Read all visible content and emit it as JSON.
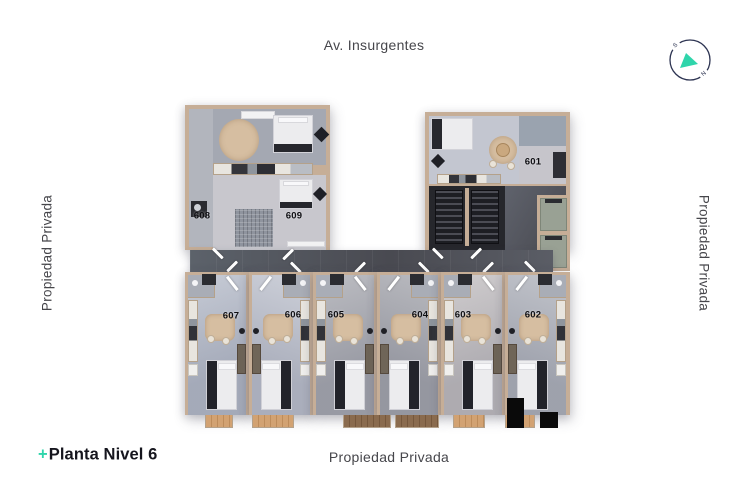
{
  "labels": {
    "street": "Av. Insurgentes",
    "left": "Propiedad Privada",
    "right": "Propiedad Privada",
    "bottom": "Propiedad Privada"
  },
  "footer": {
    "plus": "+",
    "title": "Planta Nivel 6"
  },
  "compass": {
    "south": "S",
    "north": "N"
  },
  "colors": {
    "accent_teal": "#2fd5ab",
    "compass_navy": "#2d3452",
    "wall_tan": "#c6ae97",
    "corridor_gray": "#53545c",
    "label_text": "#46464b",
    "title_text": "#16161e"
  },
  "units": [
    {
      "number": "601"
    },
    {
      "number": "602"
    },
    {
      "number": "603"
    },
    {
      "number": "604"
    },
    {
      "number": "605"
    },
    {
      "number": "606"
    },
    {
      "number": "607"
    },
    {
      "number": "608"
    },
    {
      "number": "609"
    }
  ]
}
